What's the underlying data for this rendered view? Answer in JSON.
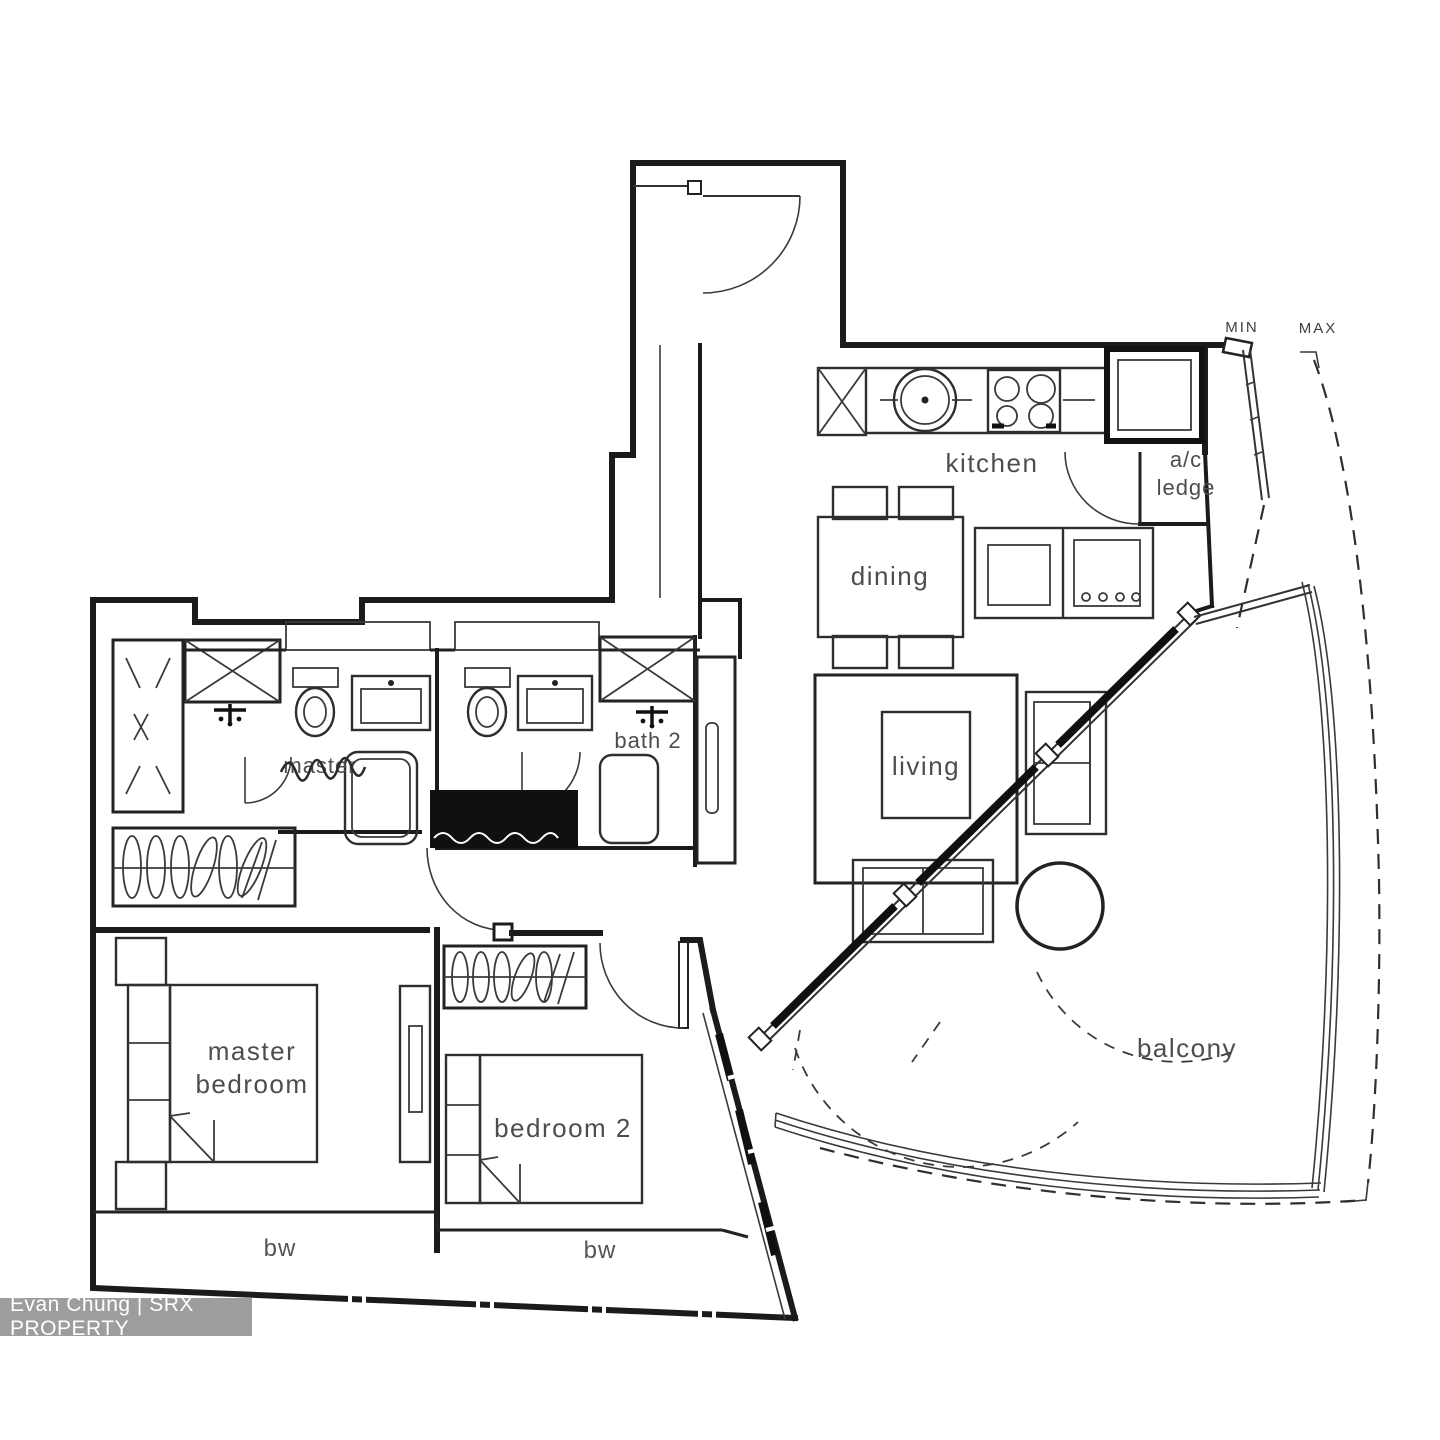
{
  "watermark": {
    "text": "Evan Chung | SRX PROPERTY",
    "bar_color": "#a8a8a8",
    "text_color": "#ffffff"
  },
  "annotations": {
    "min": "MIN",
    "max": "MAX"
  },
  "rooms": {
    "kitchen": {
      "label": "kitchen"
    },
    "ac_ledge": {
      "label_line1": "a/c",
      "label_line2": "ledge"
    },
    "dining": {
      "label": "dining"
    },
    "living": {
      "label": "living"
    },
    "balcony": {
      "label": "balcony"
    },
    "master_bath": {
      "label": "master"
    },
    "bath_2": {
      "label": "bath 2"
    },
    "master_bedroom": {
      "label_line1": "master",
      "label_line2": "bedroom"
    },
    "bedroom_2": {
      "label": "bedroom 2"
    },
    "bay_window_left": {
      "label": "bw"
    },
    "bay_window_right": {
      "label": "bw"
    }
  },
  "colors": {
    "line": "#1b1b1b",
    "label": "#4d4d4d",
    "background": "#ffffff"
  }
}
